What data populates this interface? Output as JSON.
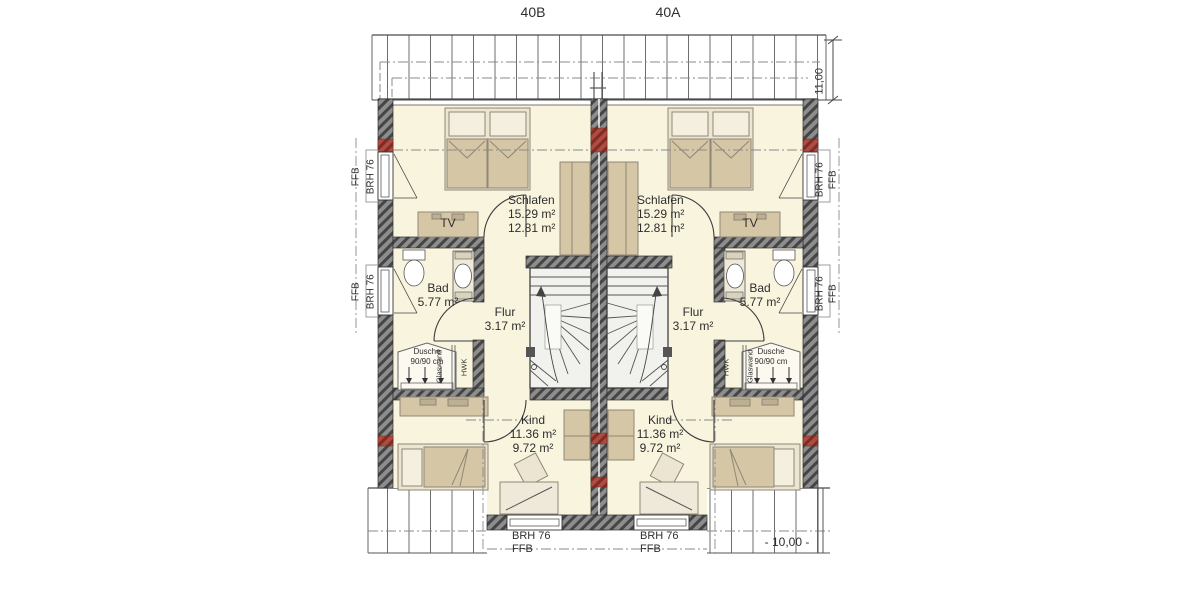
{
  "plan": {
    "unit_left_label": "40B",
    "unit_right_label": "40A",
    "dim_right": "11,00",
    "level_bottom": "- 10,00 -",
    "ffb": "FFB",
    "brh": "BRH 76"
  },
  "unit_left": {
    "schlafen": {
      "name": "Schlafen",
      "area1": "15.29 m²",
      "area2": "12.81 m²"
    },
    "bad": {
      "name": "Bad",
      "area": "5.77 m²"
    },
    "flur": {
      "name": "Flur",
      "area": "3.17 m²"
    },
    "kind": {
      "name": "Kind",
      "area1": "11.36 m²",
      "area2": "9.72 m²"
    },
    "tv": "TV",
    "dusche": {
      "line1": "Dusche",
      "line2": "90/90 cm"
    },
    "glaswand": "Glaswand",
    "hwk": "HWK"
  },
  "unit_right": {
    "schlafen": {
      "name": "Schlafen",
      "area1": "15.29 m²",
      "area2": "12.81 m²"
    },
    "bad": {
      "name": "Bad",
      "area": "5.77 m²"
    },
    "flur": {
      "name": "Flur",
      "area": "3.17 m²"
    },
    "kind": {
      "name": "Kind",
      "area1": "11.36 m²",
      "area2": "9.72 m²"
    },
    "tv": "TV",
    "dusche": {
      "line1": "Dusche",
      "line2": "90/90 cm"
    },
    "glaswand": "Glaswand",
    "hwk": "HWK"
  },
  "colors": {
    "wall": "#8d8d8d",
    "wall_hatch": "#454545",
    "floor": "#f8f4de",
    "furniture": "#d5c6a5",
    "furniture_light": "#ece5d2",
    "red_accent": "#b14a3f",
    "line": "#4a4a4a"
  }
}
